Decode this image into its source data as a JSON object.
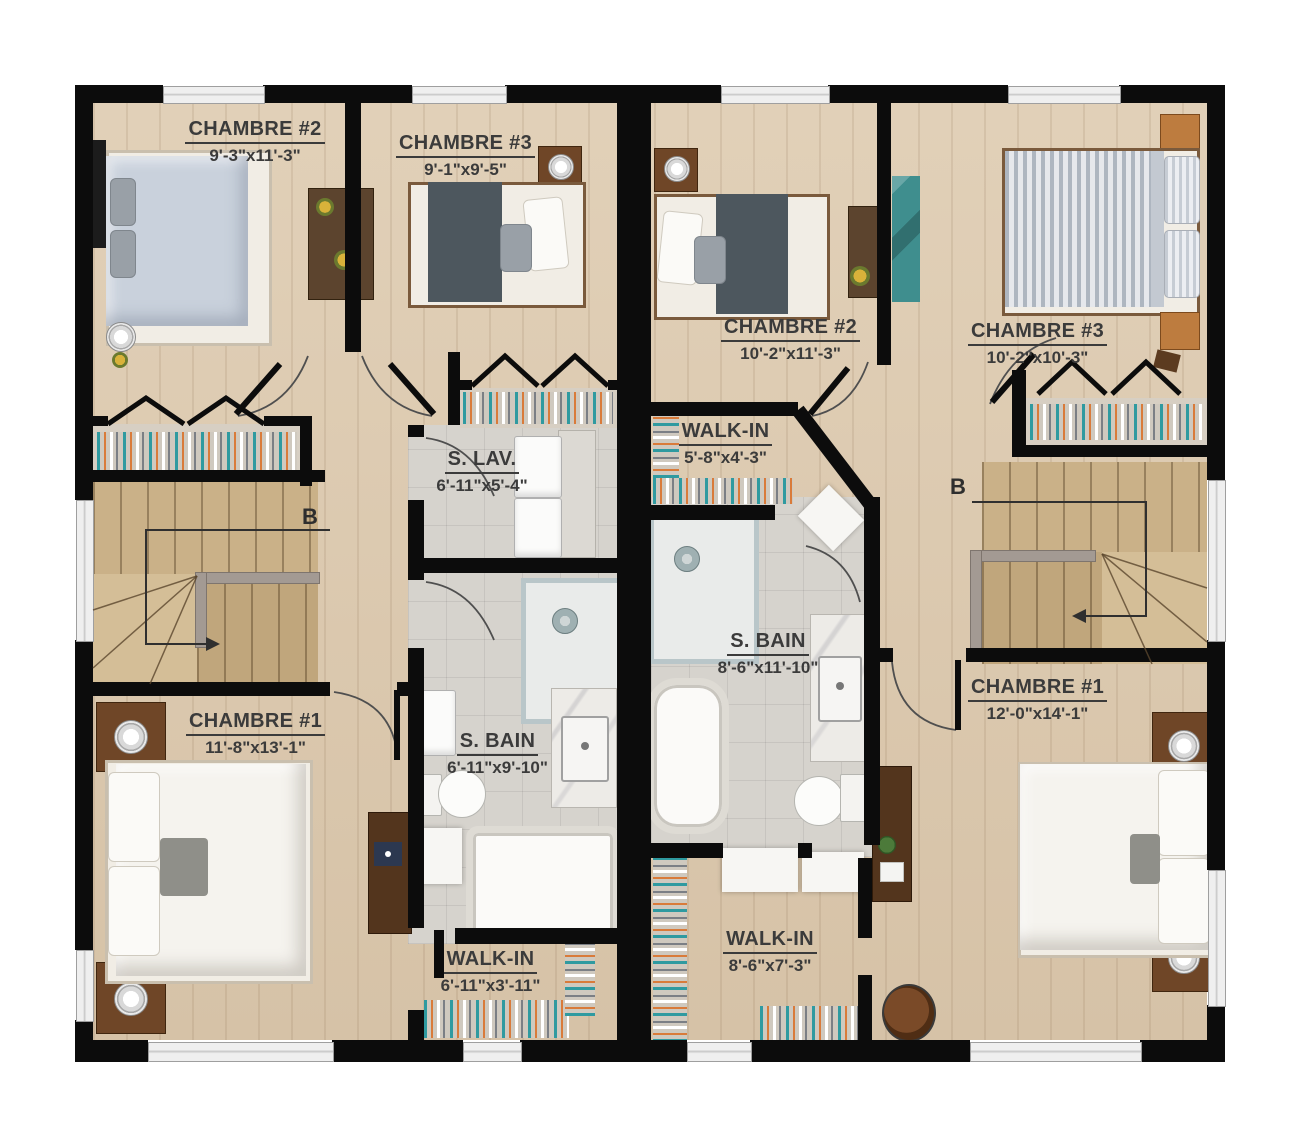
{
  "plan": {
    "type": "second-floor duplex plan",
    "colors": {
      "wall": "#0c0c0c",
      "wood_floor": "#decbb0",
      "tile_floor": "#d6d3cd",
      "stairs": "#cab188",
      "label_text": "#3b3b3b",
      "teal_accent": "#3f8e8e"
    }
  },
  "units": {
    "left": {
      "stair_label": "B",
      "rooms": [
        {
          "name": "CHAMBRE #2",
          "dims": "9'-3\"x11'-3\""
        },
        {
          "name": "CHAMBRE #3",
          "dims": "9'-1\"x9'-5\""
        },
        {
          "name": "S. LAV.",
          "dims": "6'-11\"x5'-4\""
        },
        {
          "name": "S. BAIN",
          "dims": "6'-11\"x9'-10\""
        },
        {
          "name": "CHAMBRE #1",
          "dims": "11'-8\"x13'-1\""
        },
        {
          "name": "WALK-IN",
          "dims": "6'-11\"x3'-11\""
        }
      ]
    },
    "right": {
      "stair_label": "B",
      "rooms": [
        {
          "name": "CHAMBRE #2",
          "dims": "10'-2\"x11'-3\""
        },
        {
          "name": "CHAMBRE #3",
          "dims": "10'-2\"x10'-3\""
        },
        {
          "name": "WALK-IN",
          "dims": "5'-8\"x4'-3\""
        },
        {
          "name": "S. BAIN",
          "dims": "8'-6\"x11'-10\""
        },
        {
          "name": "CHAMBRE #1",
          "dims": "12'-0\"x14'-1\""
        },
        {
          "name": "WALK-IN",
          "dims": "8'-6\"x7'-3\""
        }
      ]
    }
  }
}
